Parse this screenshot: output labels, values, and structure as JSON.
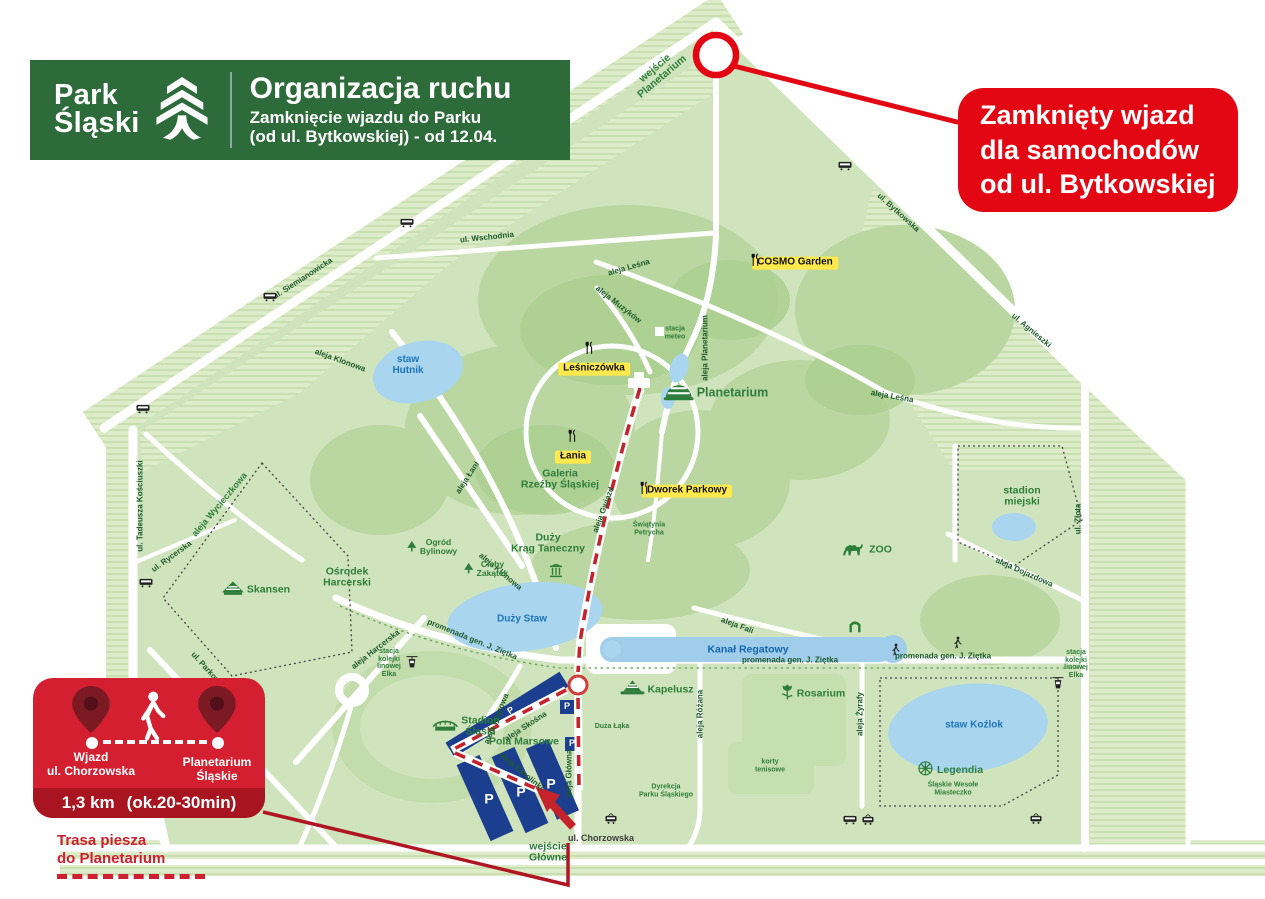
{
  "header": {
    "brand_line1": "Park",
    "brand_line2": "Śląski",
    "title": "Organizacja ruchu",
    "subtitle_line1": "Zamknięcie wjazdu do Parku",
    "subtitle_line2": "(od ul. Bytkowskiej) - od 12.04."
  },
  "closed_callout": {
    "line1": "Zamknięty wjazd",
    "line2": "dla samochodów",
    "line3": "od ul. Bytkowskiej"
  },
  "walk_panel": {
    "from_line1": "Wjazd",
    "from_line2": "ul. Chorzowska",
    "to_line1": "Planetarium",
    "to_line2": "Śląskie",
    "distance": "1,3 km",
    "duration": "(ok.20-30min)"
  },
  "walk_note": {
    "line1": "Trasa piesza",
    "line2": "do Planetarium"
  },
  "colors": {
    "brand_green": "#2d6b3a",
    "alert_red": "#e30613",
    "panel_red": "#d31f2f",
    "panel_red_dark": "#a8141f",
    "poi_yellow": "#ffe94d",
    "parking_blue": "#1c3e8f",
    "water_blue": "#a9d5ef",
    "route_red": "#c4232b",
    "park_green": "#cfe4bc"
  },
  "map": {
    "labels": [
      {
        "name": "street-ul-siemianowicka",
        "text": "ul. Siemianowicka",
        "x": 303,
        "y": 279,
        "rot": -33,
        "cls": "street"
      },
      {
        "name": "street-ul-wschodnia",
        "text": "ul. Wschodnia",
        "x": 487,
        "y": 238,
        "rot": -6,
        "cls": "street"
      },
      {
        "name": "street-aleja-klonowa-1",
        "text": "aleja Klonowa",
        "x": 340,
        "y": 361,
        "rot": 20,
        "cls": "street"
      },
      {
        "name": "street-aleja-klonowa-2",
        "text": "aleja Klonowa",
        "x": 500,
        "y": 572,
        "rot": 40,
        "cls": "street"
      },
      {
        "name": "street-aleja-lesna-1",
        "text": "aleja Leśna",
        "x": 629,
        "y": 268,
        "rot": -16,
        "cls": "street"
      },
      {
        "name": "street-aleja-muzykow",
        "text": "aleja Muzyków",
        "x": 618,
        "y": 305,
        "rot": 38,
        "cls": "street"
      },
      {
        "name": "street-aleja-planetarium",
        "text": "aleja Planetarium",
        "x": 706,
        "y": 348,
        "rot": -90,
        "cls": "street"
      },
      {
        "name": "street-aleja-lesna-2",
        "text": "aleja Leśna",
        "x": 892,
        "y": 397,
        "rot": 10,
        "cls": "street"
      },
      {
        "name": "street-ul-bytkowska",
        "text": "ul. Bytkowska",
        "x": 898,
        "y": 213,
        "rot": 42,
        "cls": "street"
      },
      {
        "name": "street-ul-agnieszki",
        "text": "ul. Agnieszki",
        "x": 1031,
        "y": 331,
        "rot": 40,
        "cls": "street"
      },
      {
        "name": "street-ul-zlota",
        "text": "ul. Złota",
        "x": 1079,
        "y": 519,
        "rot": -90,
        "cls": "street"
      },
      {
        "name": "street-aleja-dojazdowa",
        "text": "aleja Dojazdowa",
        "x": 1024,
        "y": 573,
        "rot": 24,
        "cls": "street"
      },
      {
        "name": "street-ul-tadeusza-kosciuszki",
        "text": "ul. Tadeusza Kościuszki",
        "x": 141,
        "y": 506,
        "rot": -90,
        "cls": "street"
      },
      {
        "name": "street-aleja-wycieczkowa",
        "text": "aleja Wycieczkowa",
        "x": 220,
        "y": 505,
        "rot": -50,
        "cls": "path-green"
      },
      {
        "name": "street-ul-rycerska",
        "text": "ul. Rycerska",
        "x": 172,
        "y": 557,
        "rot": -36,
        "cls": "street"
      },
      {
        "name": "street-ul-parkowa",
        "text": "ul. Parkowa",
        "x": 207,
        "y": 670,
        "rot": 48,
        "cls": "street"
      },
      {
        "name": "street-aleja-harcerska",
        "text": "aleja Harcerska",
        "x": 376,
        "y": 650,
        "rot": -38,
        "cls": "street"
      },
      {
        "name": "street-aleja-lani",
        "text": "aleja Łani",
        "x": 468,
        "y": 478,
        "rot": -57,
        "cls": "street"
      },
      {
        "name": "street-promenada-zietka-1",
        "text": "promenada gen. J. Ziętka",
        "x": 472,
        "y": 640,
        "rot": 22,
        "cls": "street"
      },
      {
        "name": "street-promenada-zietka-2",
        "text": "promenada gen. J. Ziętka",
        "x": 790,
        "y": 661,
        "rot": 0,
        "cls": "street"
      },
      {
        "name": "street-promenada-zietka-3",
        "text": "promenada gen. J. Ziętka",
        "x": 943,
        "y": 657,
        "rot": 0,
        "cls": "street"
      },
      {
        "name": "street-aleja-fali",
        "text": "aleja Fali",
        "x": 737,
        "y": 626,
        "rot": 20,
        "cls": "street"
      },
      {
        "name": "street-aleja-wiazowa",
        "text": "aleja Wiązowa",
        "x": 497,
        "y": 719,
        "rot": -68,
        "cls": "street"
      },
      {
        "name": "street-aleja-skosna",
        "text": "aleja Skośna",
        "x": 526,
        "y": 727,
        "rot": -33,
        "cls": "street"
      },
      {
        "name": "street-aleja-karolinki",
        "text": "aleja Karolinki",
        "x": 521,
        "y": 772,
        "rot": 40,
        "cls": "street"
      },
      {
        "name": "street-aleja-glowna",
        "text": "aleja Główna",
        "x": 570,
        "y": 774,
        "rot": -90,
        "cls": "street"
      },
      {
        "name": "street-aleja-rozana",
        "text": "aleja Różana",
        "x": 701,
        "y": 714,
        "rot": -90,
        "cls": "street"
      },
      {
        "name": "street-aleja-zyrafy",
        "text": "aleja Żyrafy",
        "x": 861,
        "y": 714,
        "rot": -90,
        "cls": "street"
      },
      {
        "name": "street-aleja-gwiazd",
        "text": "aleja Gwiazd",
        "x": 604,
        "y": 510,
        "rot": -70,
        "cls": "street"
      },
      {
        "name": "street-ul-chorzowska",
        "text": "ul. Chorzowska",
        "x": 601,
        "y": 839,
        "rot": 0,
        "cls": "street-dark"
      },
      {
        "name": "place-planetarium",
        "text": "Planetarium",
        "x": 716,
        "y": 393,
        "rot": 0,
        "cls": "place-lg",
        "icon": "dome"
      },
      {
        "name": "place-galeria-rzezby",
        "text": "Galeria\nRzeźby Śląskiej",
        "x": 560,
        "y": 480,
        "rot": 0,
        "cls": "place"
      },
      {
        "name": "place-duzy-krag-taneczny",
        "text": "Duży\nKrąg Taneczny",
        "x": 548,
        "y": 544,
        "rot": 0,
        "cls": "place"
      },
      {
        "name": "icon-krag-column",
        "text": "",
        "x": 556,
        "y": 573,
        "rot": 0,
        "cls": "icon-only",
        "icon": "column"
      },
      {
        "name": "place-swiatynia-petrycha",
        "text": "Świątynia\nPetrycha",
        "x": 649,
        "y": 529,
        "rot": 0,
        "cls": "place-xs"
      },
      {
        "name": "place-cichy-zakatek",
        "text": "Cichy\nZakątek",
        "x": 486,
        "y": 569,
        "rot": 0,
        "cls": "place-sm",
        "icon": "tree"
      },
      {
        "name": "place-ogrod-bylinowy",
        "text": "Ogród\nBylinowy",
        "x": 432,
        "y": 547,
        "rot": 0,
        "cls": "place-sm",
        "icon": "tree"
      },
      {
        "name": "place-osrodek-harcerski",
        "text": "Ośrodek\nHarcerski",
        "x": 347,
        "y": 578,
        "rot": 0,
        "cls": "place"
      },
      {
        "name": "place-skansen",
        "text": "Skansen",
        "x": 256,
        "y": 590,
        "rot": 0,
        "cls": "place",
        "icon": "hut"
      },
      {
        "name": "place-stadion-slaski",
        "text": "Stadion\nŚląski",
        "x": 466,
        "y": 727,
        "rot": 0,
        "cls": "place",
        "icon": "stadium"
      },
      {
        "name": "place-pola-marsowe",
        "text": "Pola Marsowe",
        "x": 524,
        "y": 742,
        "rot": 0,
        "cls": "place"
      },
      {
        "name": "place-kapelusz",
        "text": "Kapelusz",
        "x": 657,
        "y": 690,
        "rot": 0,
        "cls": "place",
        "icon": "hat"
      },
      {
        "name": "place-rosarium",
        "text": "Rosarium",
        "x": 813,
        "y": 694,
        "rot": 0,
        "cls": "place",
        "icon": "rose"
      },
      {
        "name": "place-legendia",
        "text": "Legendia",
        "x": 950,
        "y": 770,
        "rot": 0,
        "cls": "place",
        "icon": "ferris"
      },
      {
        "name": "place-legendia-sub",
        "text": "Śląskie Wesołe\nMiasteczko",
        "x": 953,
        "y": 789,
        "rot": 0,
        "cls": "place-xs"
      },
      {
        "name": "place-zoo",
        "text": "ZOO",
        "x": 866,
        "y": 550,
        "rot": 0,
        "cls": "place",
        "icon": "camel"
      },
      {
        "name": "place-stadion-miejski",
        "text": "stadion\nmiejski",
        "x": 1022,
        "y": 497,
        "rot": 0,
        "cls": "place"
      },
      {
        "name": "place-korty-tenisowe",
        "text": "korty\ntenisowe",
        "x": 770,
        "y": 766,
        "rot": 0,
        "cls": "place-xs"
      },
      {
        "name": "place-duza-laka",
        "text": "Duża Łąka",
        "x": 612,
        "y": 727,
        "rot": 0,
        "cls": "place-xs"
      },
      {
        "name": "place-dyrekcja",
        "text": "Dyrekcja\nParku Śląskiego",
        "x": 666,
        "y": 791,
        "rot": 0,
        "cls": "place-xs"
      },
      {
        "name": "place-stacja-meteo",
        "text": "stacja\nmeteo",
        "x": 675,
        "y": 333,
        "rot": 0,
        "cls": "place-xs"
      },
      {
        "name": "place-stacja-elka-west",
        "text": "stacja\nkolejki\nlinowej\nElka",
        "x": 389,
        "y": 663,
        "rot": 0,
        "cls": "place-xs"
      },
      {
        "name": "place-stacja-elka-east",
        "text": "stacja\nkolejki\nlinowej\nElka",
        "x": 1076,
        "y": 664,
        "rot": 0,
        "cls": "place-xs"
      },
      {
        "name": "place-wejscie-glowne",
        "text": "wejście\nGłówne",
        "x": 548,
        "y": 853,
        "rot": 0,
        "cls": "place"
      },
      {
        "name": "place-wejscie-planetarium",
        "text": "wejście\nPlanetarium",
        "x": 659,
        "y": 73,
        "rot": -40,
        "cls": "place"
      },
      {
        "name": "poi-cosmo-garden",
        "text": "COSMO Garden",
        "x": 795,
        "y": 263,
        "rot": 0,
        "cls": "poi-yellow"
      },
      {
        "name": "icon-dining-cosmo",
        "text": "",
        "x": 755,
        "y": 262,
        "rot": 0,
        "cls": "icon-only",
        "icon": "dining"
      },
      {
        "name": "poi-lesniczowka",
        "text": "Leśniczówka",
        "x": 594,
        "y": 369,
        "rot": 0,
        "cls": "poi-yellow"
      },
      {
        "name": "icon-dining-lesniczowka",
        "text": "",
        "x": 589,
        "y": 350,
        "rot": 0,
        "cls": "icon-only",
        "icon": "dining"
      },
      {
        "name": "poi-lania",
        "text": "Łania",
        "x": 573,
        "y": 457,
        "rot": 0,
        "cls": "poi-yellow"
      },
      {
        "name": "icon-dining-lania",
        "text": "",
        "x": 572,
        "y": 438,
        "rot": 0,
        "cls": "icon-only",
        "icon": "dining"
      },
      {
        "name": "poi-dworek-parkowy",
        "text": "Dworek Parkowy",
        "x": 687,
        "y": 491,
        "rot": 0,
        "cls": "poi-yellow"
      },
      {
        "name": "icon-dining-dworek",
        "text": "",
        "x": 644,
        "y": 490,
        "rot": 0,
        "cls": "icon-only",
        "icon": "dining"
      },
      {
        "name": "water-staw-hutnik",
        "text": "staw\nHutnik",
        "x": 408,
        "y": 366,
        "rot": 0,
        "cls": "water"
      },
      {
        "name": "water-duzy-staw",
        "text": "Duży Staw",
        "x": 522,
        "y": 620,
        "rot": 0,
        "cls": "water"
      },
      {
        "name": "water-kanal-regatowy",
        "text": "Kanał Regatowy",
        "x": 748,
        "y": 650,
        "rot": 0,
        "cls": "water-dark"
      },
      {
        "name": "water-staw-kozlok",
        "text": "staw Koźlok",
        "x": 974,
        "y": 726,
        "rot": 0,
        "cls": "water"
      },
      {
        "name": "parking-p-skosna",
        "text": "P",
        "x": 511,
        "y": 711,
        "rot": -33,
        "cls": "parking-p-sm"
      },
      {
        "name": "parking-p-square-1",
        "text": "P",
        "x": 567,
        "y": 707,
        "rot": 0,
        "cls": "parking-p-sm"
      },
      {
        "name": "parking-p-square-2",
        "text": "P",
        "x": 572,
        "y": 744,
        "rot": 0,
        "cls": "parking-p-sm"
      },
      {
        "name": "parking-p-1",
        "text": "P",
        "x": 489,
        "y": 799,
        "rot": 0,
        "cls": "parking-p"
      },
      {
        "name": "parking-p-2",
        "text": "P",
        "x": 521,
        "y": 792,
        "rot": 0,
        "cls": "parking-p"
      },
      {
        "name": "parking-p-3",
        "text": "P",
        "x": 551,
        "y": 784,
        "rot": 0,
        "cls": "parking-p"
      },
      {
        "name": "icon-bus-siemianowicka-1",
        "text": "",
        "x": 270,
        "y": 297,
        "rot": 0,
        "cls": "icon-only",
        "icon": "bus"
      },
      {
        "name": "icon-bus-siemianowicka-2",
        "text": "",
        "x": 407,
        "y": 223,
        "rot": 0,
        "cls": "icon-only",
        "icon": "bus"
      },
      {
        "name": "icon-bus-kosciuszki-1",
        "text": "",
        "x": 143,
        "y": 409,
        "rot": 0,
        "cls": "icon-only",
        "icon": "bus"
      },
      {
        "name": "icon-bus-kosciuszki-2",
        "text": "",
        "x": 146,
        "y": 583,
        "rot": 0,
        "cls": "icon-only",
        "icon": "bus"
      },
      {
        "name": "icon-bus-bytkowska",
        "text": "",
        "x": 845,
        "y": 166,
        "rot": 0,
        "cls": "icon-only",
        "icon": "bus"
      },
      {
        "name": "icon-bus-chorzowska",
        "text": "",
        "x": 850,
        "y": 820,
        "rot": 0,
        "cls": "icon-only",
        "icon": "bus"
      },
      {
        "name": "icon-tram-1",
        "text": "",
        "x": 611,
        "y": 820,
        "rot": 0,
        "cls": "icon-only",
        "icon": "tram"
      },
      {
        "name": "icon-tram-2",
        "text": "",
        "x": 868,
        "y": 821,
        "rot": 0,
        "cls": "icon-only",
        "icon": "tram"
      },
      {
        "name": "icon-tram-3",
        "text": "",
        "x": 1036,
        "y": 820,
        "rot": 0,
        "cls": "icon-only",
        "icon": "tram"
      },
      {
        "name": "icon-cablecar-west",
        "text": "",
        "x": 412,
        "y": 664,
        "rot": 0,
        "cls": "icon-only",
        "icon": "cablecar"
      },
      {
        "name": "icon-cablecar-east",
        "text": "",
        "x": 1058,
        "y": 685,
        "rot": 0,
        "cls": "icon-only",
        "icon": "cablecar"
      },
      {
        "name": "icon-walker-promenade-1",
        "text": "",
        "x": 896,
        "y": 652,
        "rot": 0,
        "cls": "icon-only",
        "icon": "walker"
      },
      {
        "name": "icon-walker-promenade-2",
        "text": "",
        "x": 958,
        "y": 645,
        "rot": 0,
        "cls": "icon-only",
        "icon": "walker"
      },
      {
        "name": "icon-park-gate",
        "text": "",
        "x": 855,
        "y": 628,
        "rot": 0,
        "cls": "icon-only",
        "icon": "gate"
      }
    ]
  }
}
